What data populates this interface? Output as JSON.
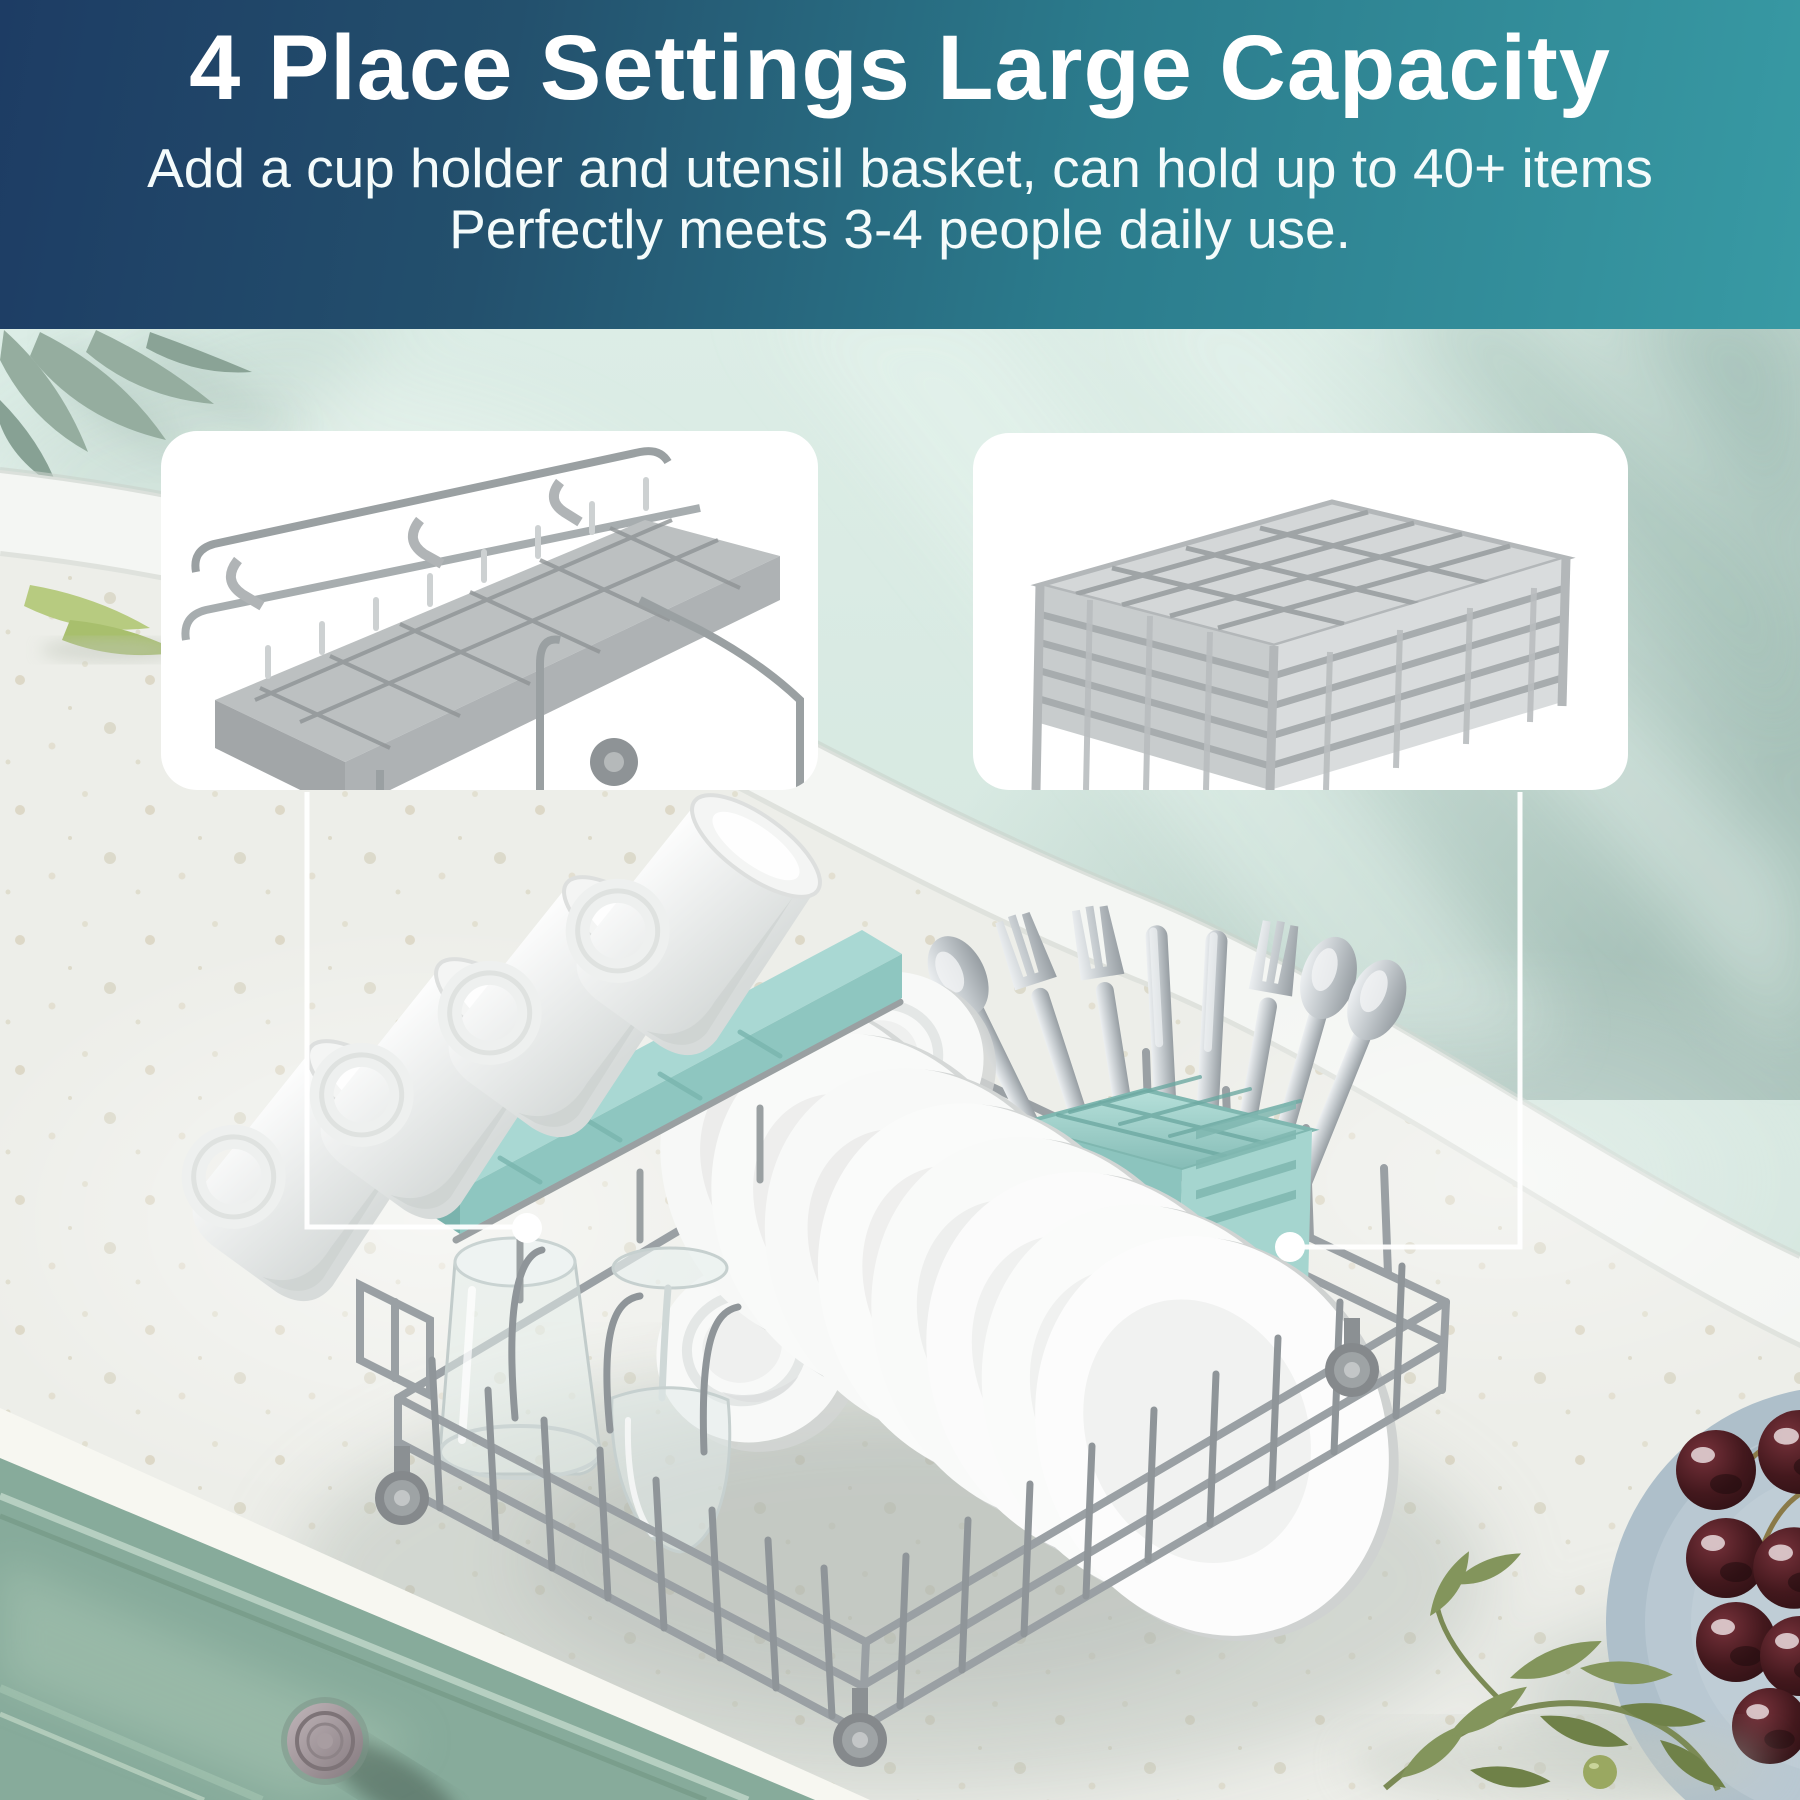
{
  "banner": {
    "title": "4 Place Settings Large Capacity",
    "subtitle_line1": "Add a cup holder and utensil basket, can hold up to 40+ items",
    "subtitle_line2": "Perfectly meets 3-4 people daily use."
  },
  "scene": {
    "callouts": [
      {
        "name": "cup-holder-shelf",
        "shape": "white rounded card with gray cup shelf photo",
        "leader": "line with dot to teal cup rail"
      },
      {
        "name": "utensil-basket",
        "shape": "white rounded card with gray utensil basket photo",
        "leader": "line with dot to teal cutlery basket"
      }
    ],
    "contents": [
      "4 cups on teal cup holder",
      "4 bowls",
      "8 plates",
      "cutlery in teal utensil basket",
      "drinking glass",
      "wine glass",
      "wire dish rack with wheels",
      "blue plate with cherries",
      "olive branch",
      "bamboo leaves"
    ]
  },
  "palette": {
    "banner_gradient_start": "#1d3c64",
    "banner_gradient_end": "#389aa4",
    "banner_text": "#ffffff",
    "wall_mint": "#d3e6de",
    "baseboard_white": "#f4f6f3",
    "countertop": "#edeee9",
    "cabinet_green": "#87ab9b",
    "teal_accent": "#a9d8d3",
    "wire_gray": "#9aa0a4",
    "plate_blue_gray": "#aebfca",
    "cherry_dark": "#321317",
    "olive_leaf": "#7e9157"
  }
}
